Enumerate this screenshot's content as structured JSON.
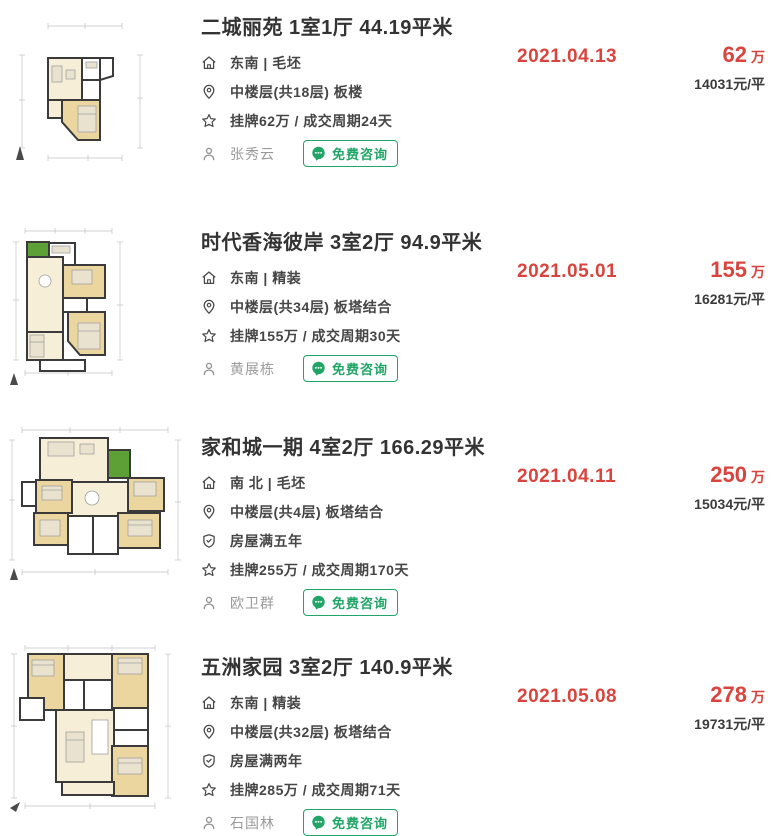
{
  "colors": {
    "accent_red": "#d9453e",
    "brand_green": "#21a567",
    "text_dark": "#333333",
    "text_body": "#464646",
    "text_gray": "#9a9a9a",
    "plan_cream": "#f6eed6",
    "plan_tan": "#ecd6a0",
    "plan_green": "#5da035",
    "plan_wall": "#3a3a3a"
  },
  "icons": {
    "home-icon": "house-outline",
    "location-pin-icon": "map-pin-outline",
    "shield-icon": "shield-check-outline",
    "star-icon": "star-outline",
    "person-icon": "user-outline",
    "consult-chat-icon": "green-chat-bubble"
  },
  "consult_button_label": "免费咨询",
  "listings": [
    {
      "title": "二城丽苑 1室1厅 44.19平米",
      "orientation": "东南 | 毛坯",
      "floor": "中楼层(共18层) 板楼",
      "listing_info": "挂牌62万 / 成交周期24天",
      "agent": "张秀云",
      "date": "2021.04.13",
      "price": "62",
      "price_unit": "万",
      "unit_price": "14031元/平"
    },
    {
      "title": "时代香海彼岸 3室2厅 94.9平米",
      "orientation": "东南 | 精装",
      "floor": "中楼层(共34层) 板塔结合",
      "listing_info": "挂牌155万 / 成交周期30天",
      "agent": "黄展栋",
      "date": "2021.05.01",
      "price": "155",
      "price_unit": "万",
      "unit_price": "16281元/平"
    },
    {
      "title": "家和城一期 4室2厅 166.29平米",
      "orientation": "南 北 | 毛坯",
      "floor": "中楼层(共4层) 板塔结合",
      "years": "房屋满五年",
      "listing_info": "挂牌255万 / 成交周期170天",
      "agent": "欧卫群",
      "date": "2021.04.11",
      "price": "250",
      "price_unit": "万",
      "unit_price": "15034元/平"
    },
    {
      "title": "五洲家园 3室2厅 140.9平米",
      "orientation": "东南 | 精装",
      "floor": "中楼层(共32层) 板塔结合",
      "years": "房屋满两年",
      "listing_info": "挂牌285万 / 成交周期71天",
      "agent": "石国林",
      "date": "2021.05.08",
      "price": "278",
      "price_unit": "万",
      "unit_price": "19731元/平"
    }
  ]
}
